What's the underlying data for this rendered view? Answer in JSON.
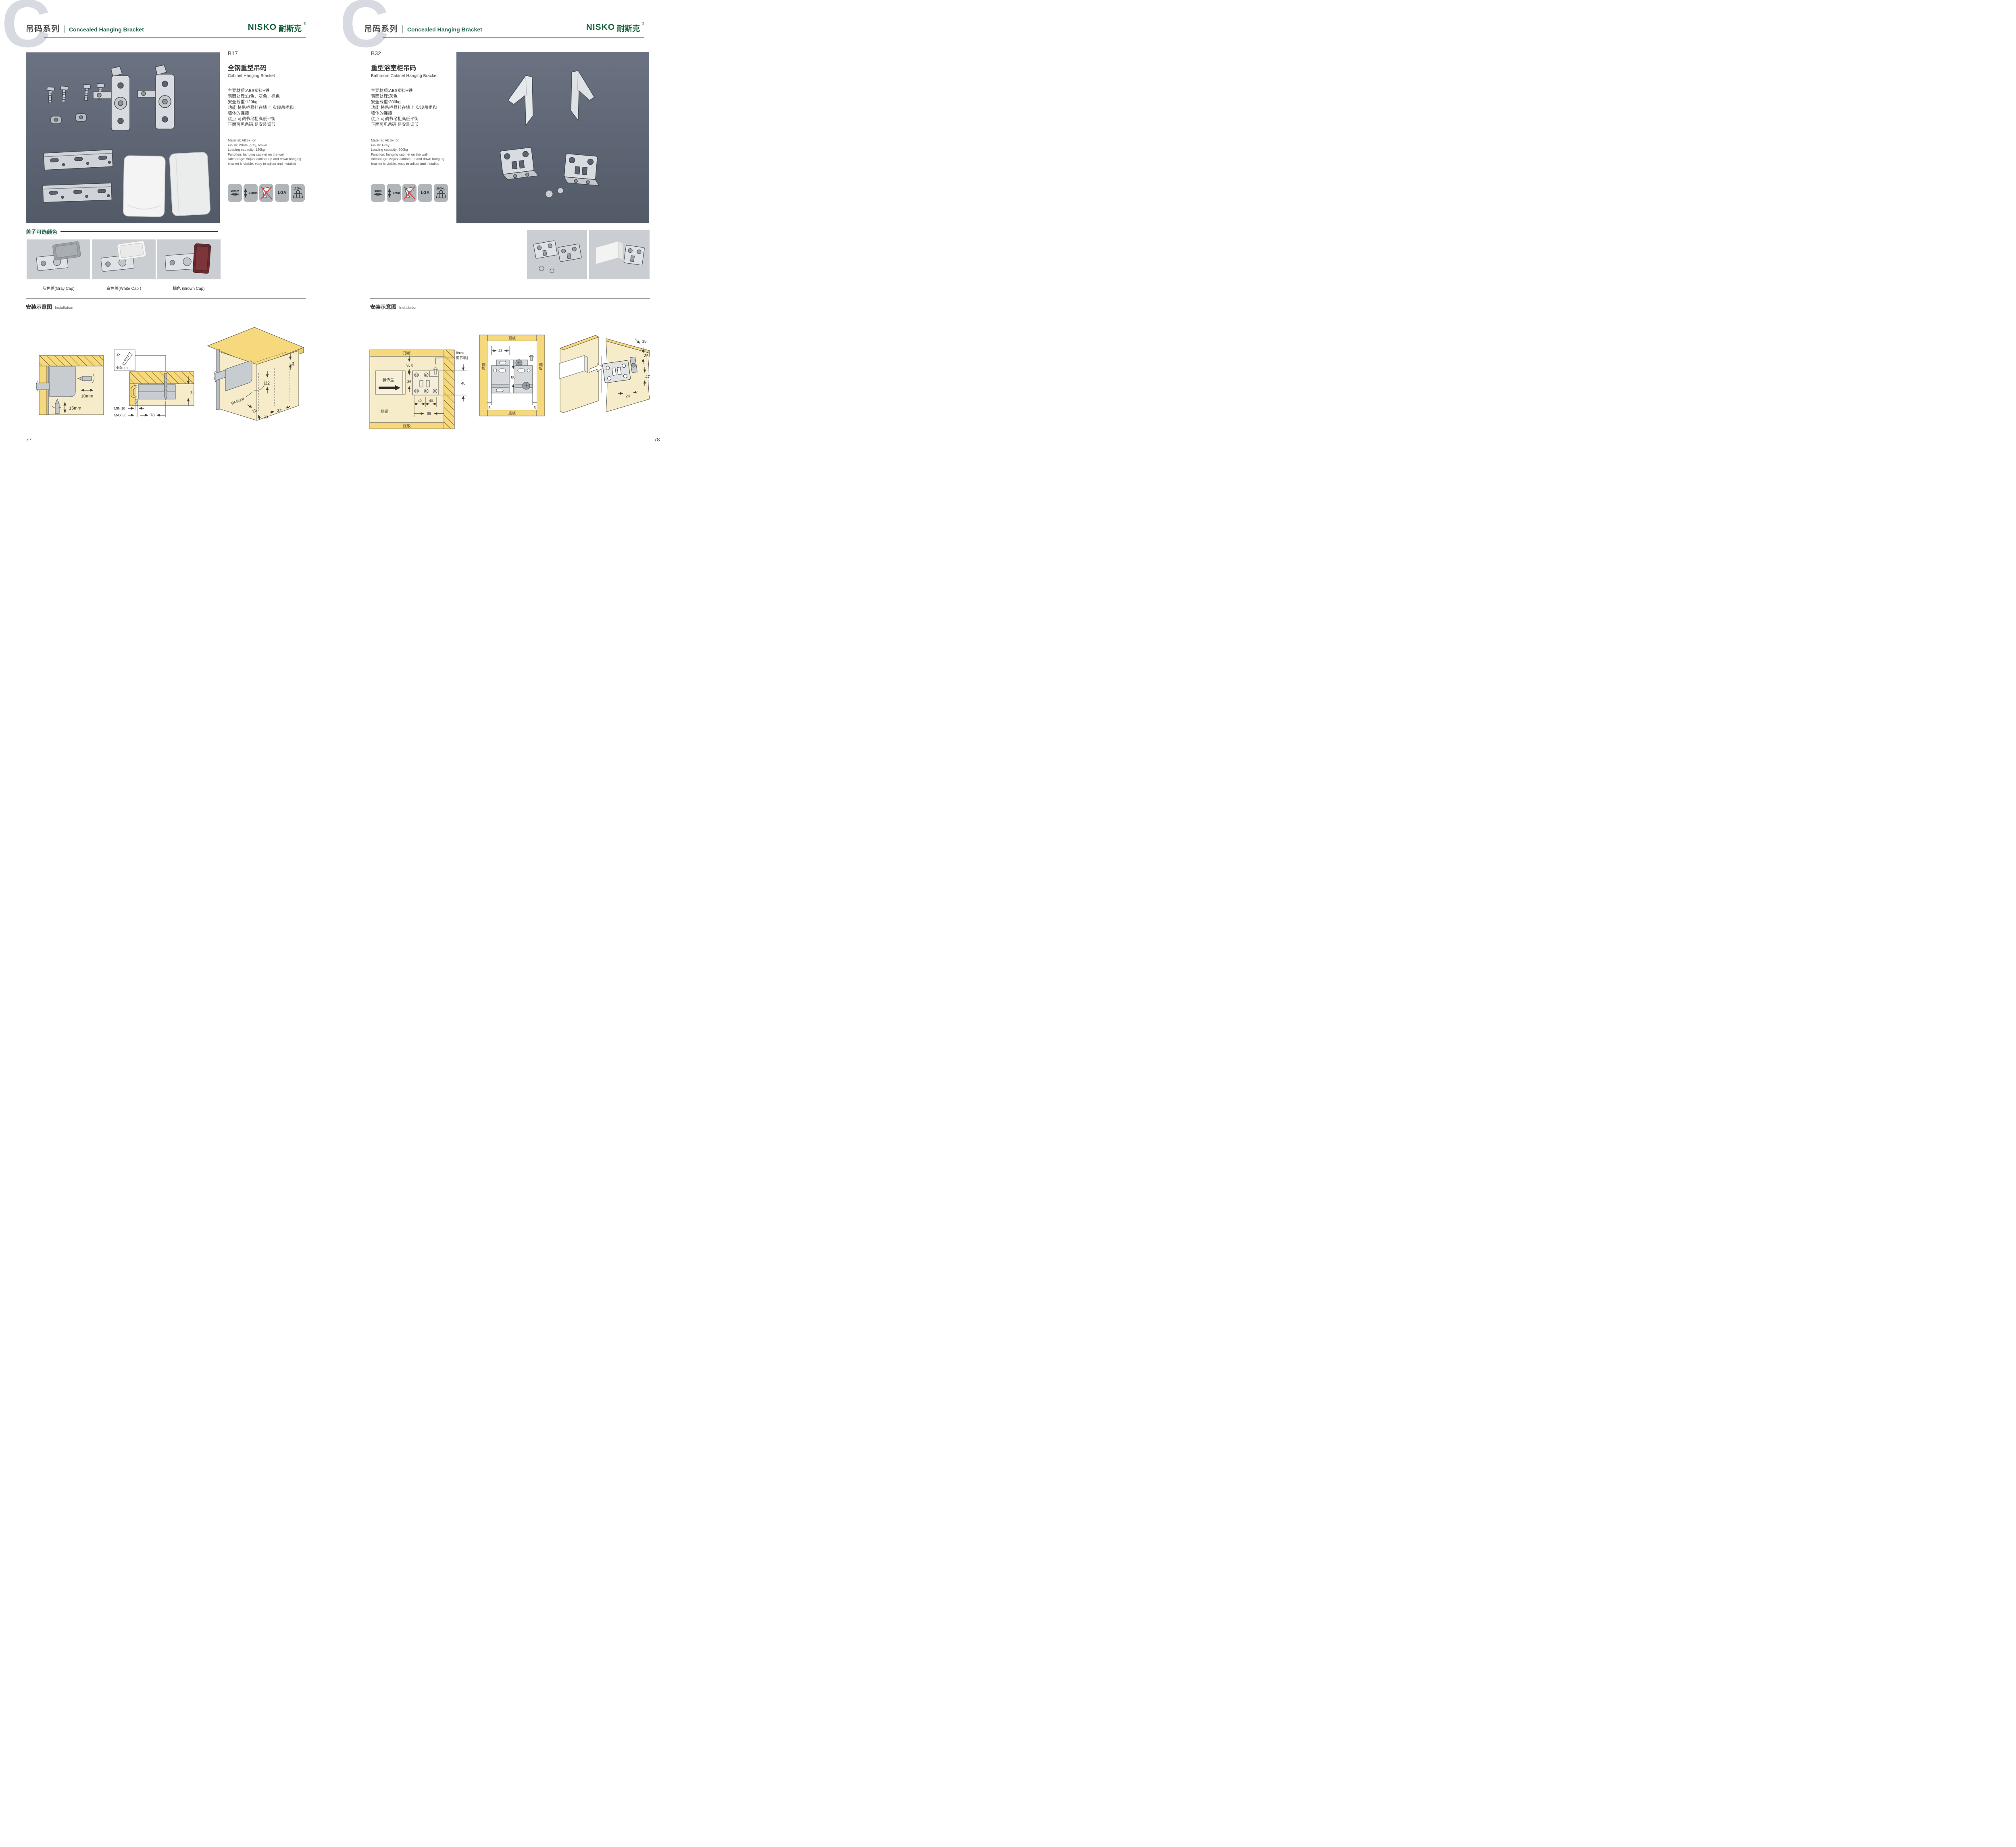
{
  "colors": {
    "brand_green": "#17603d",
    "header_green": "#226247",
    "panel_slate": "#5b6371",
    "icon_gray": "#b0b5ba",
    "wood_yellow": "#f6d87d",
    "cream": "#f6ecca",
    "metal_gray": "#d8dce0",
    "no_drill_red": "#d6453f"
  },
  "header": {
    "watermark": "C",
    "series_cn": "吊码系列",
    "series_en": "Concealed Hanging Bracket"
  },
  "logo": {
    "en": "NISKO",
    "cn": "耐斯克",
    "reg": "®"
  },
  "left_page": {
    "page_number": "77",
    "product": {
      "code": "B17",
      "name_cn": "全钢重型吊码",
      "name_en": "Cabinet Hanging Bracket",
      "specs_cn": [
        "主要材质:ABS塑料+铁",
        "表面处理:白色、灰色、棕色",
        "安全载重:120kg",
        "功能:将吊柜悬挂在墙上,实现吊柜和",
        "墙体的连接",
        "优点:可调节吊柜高低平衡",
        "正面可见吊码,易安装调节"
      ],
      "specs_en": [
        "Material: ABS+iron",
        "Finish: White, gray, brown",
        "Loading capacity: 120kg",
        "Function: hanging cabinet on the wall",
        "Advantage: Adjust cabinet up and down hanging",
        "bracket is visible, easy to adjust and installed"
      ],
      "icons": {
        "hdim": "10mm",
        "vdim": "15mm",
        "lga": "LGA",
        "load": "120Kg"
      }
    },
    "caps": {
      "title": "盖子可选颜色",
      "gray": "灰色盖(Gray Cap)",
      "white": "白色盖(White Cap )",
      "brown": "棕色 (Brown Cap)"
    },
    "install": {
      "title_cn": "安装示意图",
      "title_en": "Installation",
      "d1": {
        "hdim": "10mm",
        "vdim": "15mm"
      },
      "d2": {
        "count": "2x",
        "dia": "Φ4mm",
        "depth": "13",
        "min": "MIN.10",
        "max": "MAX.30",
        "width": "78"
      },
      "d3": {
        "back": "34",
        "height": "32",
        "radius": "RMAX4",
        "d18": "18",
        "d20": "20",
        "d32": "32"
      }
    }
  },
  "right_page": {
    "page_number": "78",
    "product": {
      "code": "B32",
      "name_cn": "重型浴室柜吊码",
      "name_en": "Bathroom Cabinet Hanging Bracket",
      "specs_cn": [
        "主要材质:ABS塑料+铁",
        "表面处理:灰色",
        "安全载重:200kg",
        "功能:将吊柜悬挂在墙上,实现吊柜和",
        "墙体的连接",
        "优点:可调节吊柜高低平衡",
        "正面可见吊码,易安装调节"
      ],
      "specs_en": [
        "Material: ABS+iron",
        "Finish: Grey",
        "Loading capacity: 200kg",
        "Function: hanging cabinet on the wall",
        "Advantage: Adjust cabinet up and down hanging",
        "bracket is visible, easy to adjust and installed"
      ],
      "icons": {
        "hdim": "4mm",
        "vdim": "8mm",
        "lga": "LGA",
        "load": "200Kg"
      }
    },
    "install": {
      "title_cn": "安装示意图",
      "title_en": "Installation",
      "dA": {
        "top": "顶板",
        "bottom": "底板",
        "side": "侧板",
        "cover": "装饰盖",
        "gap_top": "36.5",
        "gap": "36",
        "p40a": "40",
        "p40b": "40",
        "p98": "98",
        "screw1": "8mm",
        "screw2": "调节螺丝",
        "v48": "48"
      },
      "dB": {
        "top": "顶板",
        "bottom": "底板",
        "side_l": "侧板",
        "side_r": "侧板",
        "w48": "48",
        "h80": "80",
        "off_l": "5",
        "off_r": "5"
      },
      "dC": {
        "d18": "18",
        "d35": "35",
        "d47": "47",
        "d24": "24"
      }
    }
  }
}
